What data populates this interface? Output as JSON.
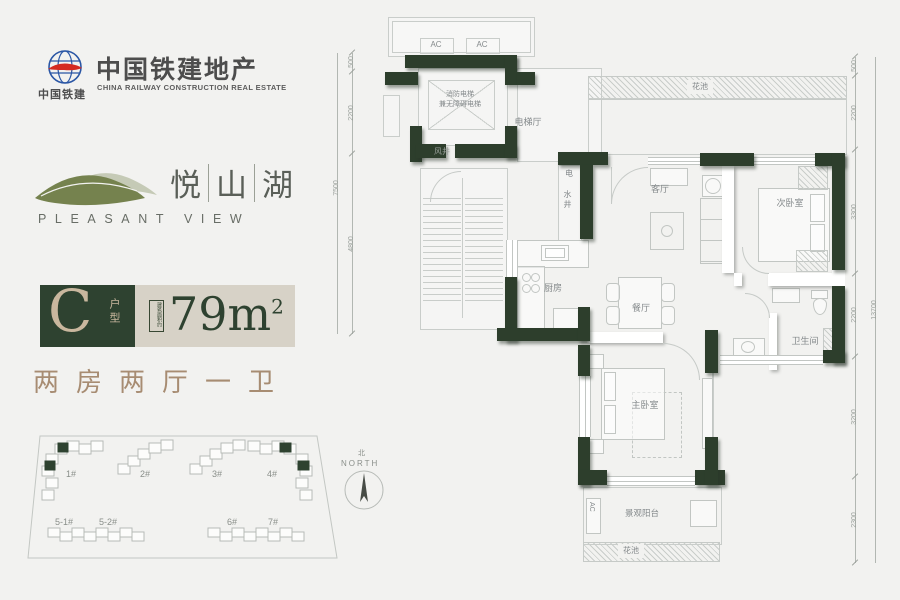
{
  "brand": {
    "logo_text": "中国铁建",
    "title": "中国铁建地产",
    "subtitle": "CHINA RAILWAY CONSTRUCTION REAL ESTATE"
  },
  "project": {
    "name_char_1": "悦",
    "name_char_2": "山",
    "name_char_3": "湖",
    "name_en": "PLEASANT VIEW"
  },
  "unit": {
    "type_letter": "C",
    "type_label": "户型",
    "area_note": "建筑面积约",
    "area_main": "79m",
    "area_sup": "2",
    "layout": "两房两厅一卫"
  },
  "site": {
    "north_cn": "北",
    "north_en": "NORTH",
    "buildings": [
      {
        "label": "1#"
      },
      {
        "label": "2#"
      },
      {
        "label": "3#"
      },
      {
        "label": "4#"
      },
      {
        "label": "5-1#"
      },
      {
        "label": "5-2#"
      },
      {
        "label": "6#"
      },
      {
        "label": "7#"
      }
    ]
  },
  "plan": {
    "labels": {
      "ac": "AC",
      "fire_elev_1": "消防电梯",
      "fire_elev_2": "兼无障碍电梯",
      "elev_hall": "电梯厅",
      "wind_shaft": "风井",
      "elec_shaft": "电",
      "water_shaft": "水井",
      "living": "客厅",
      "dining": "餐厅",
      "kitchen": "厨房",
      "bedroom2": "次卧室",
      "master": "主卧室",
      "bath": "卫生间",
      "balcony": "景观阳台",
      "flower_top": "花池",
      "flower_bottom": "花池"
    },
    "dims_left": {
      "segments": [
        "500",
        "2200",
        "4800"
      ],
      "total": "7500"
    },
    "dims_right": {
      "segments": [
        "500",
        "2200",
        "3300",
        "2200",
        "3200",
        "2300"
      ],
      "total": "13700"
    }
  },
  "colors": {
    "wall_green": "#2d3e2c",
    "badge_green": "#2e4230",
    "badge_beige": "#d7d2c7",
    "text_tan": "#a78c72",
    "accent_beige": "#c9b79e"
  }
}
